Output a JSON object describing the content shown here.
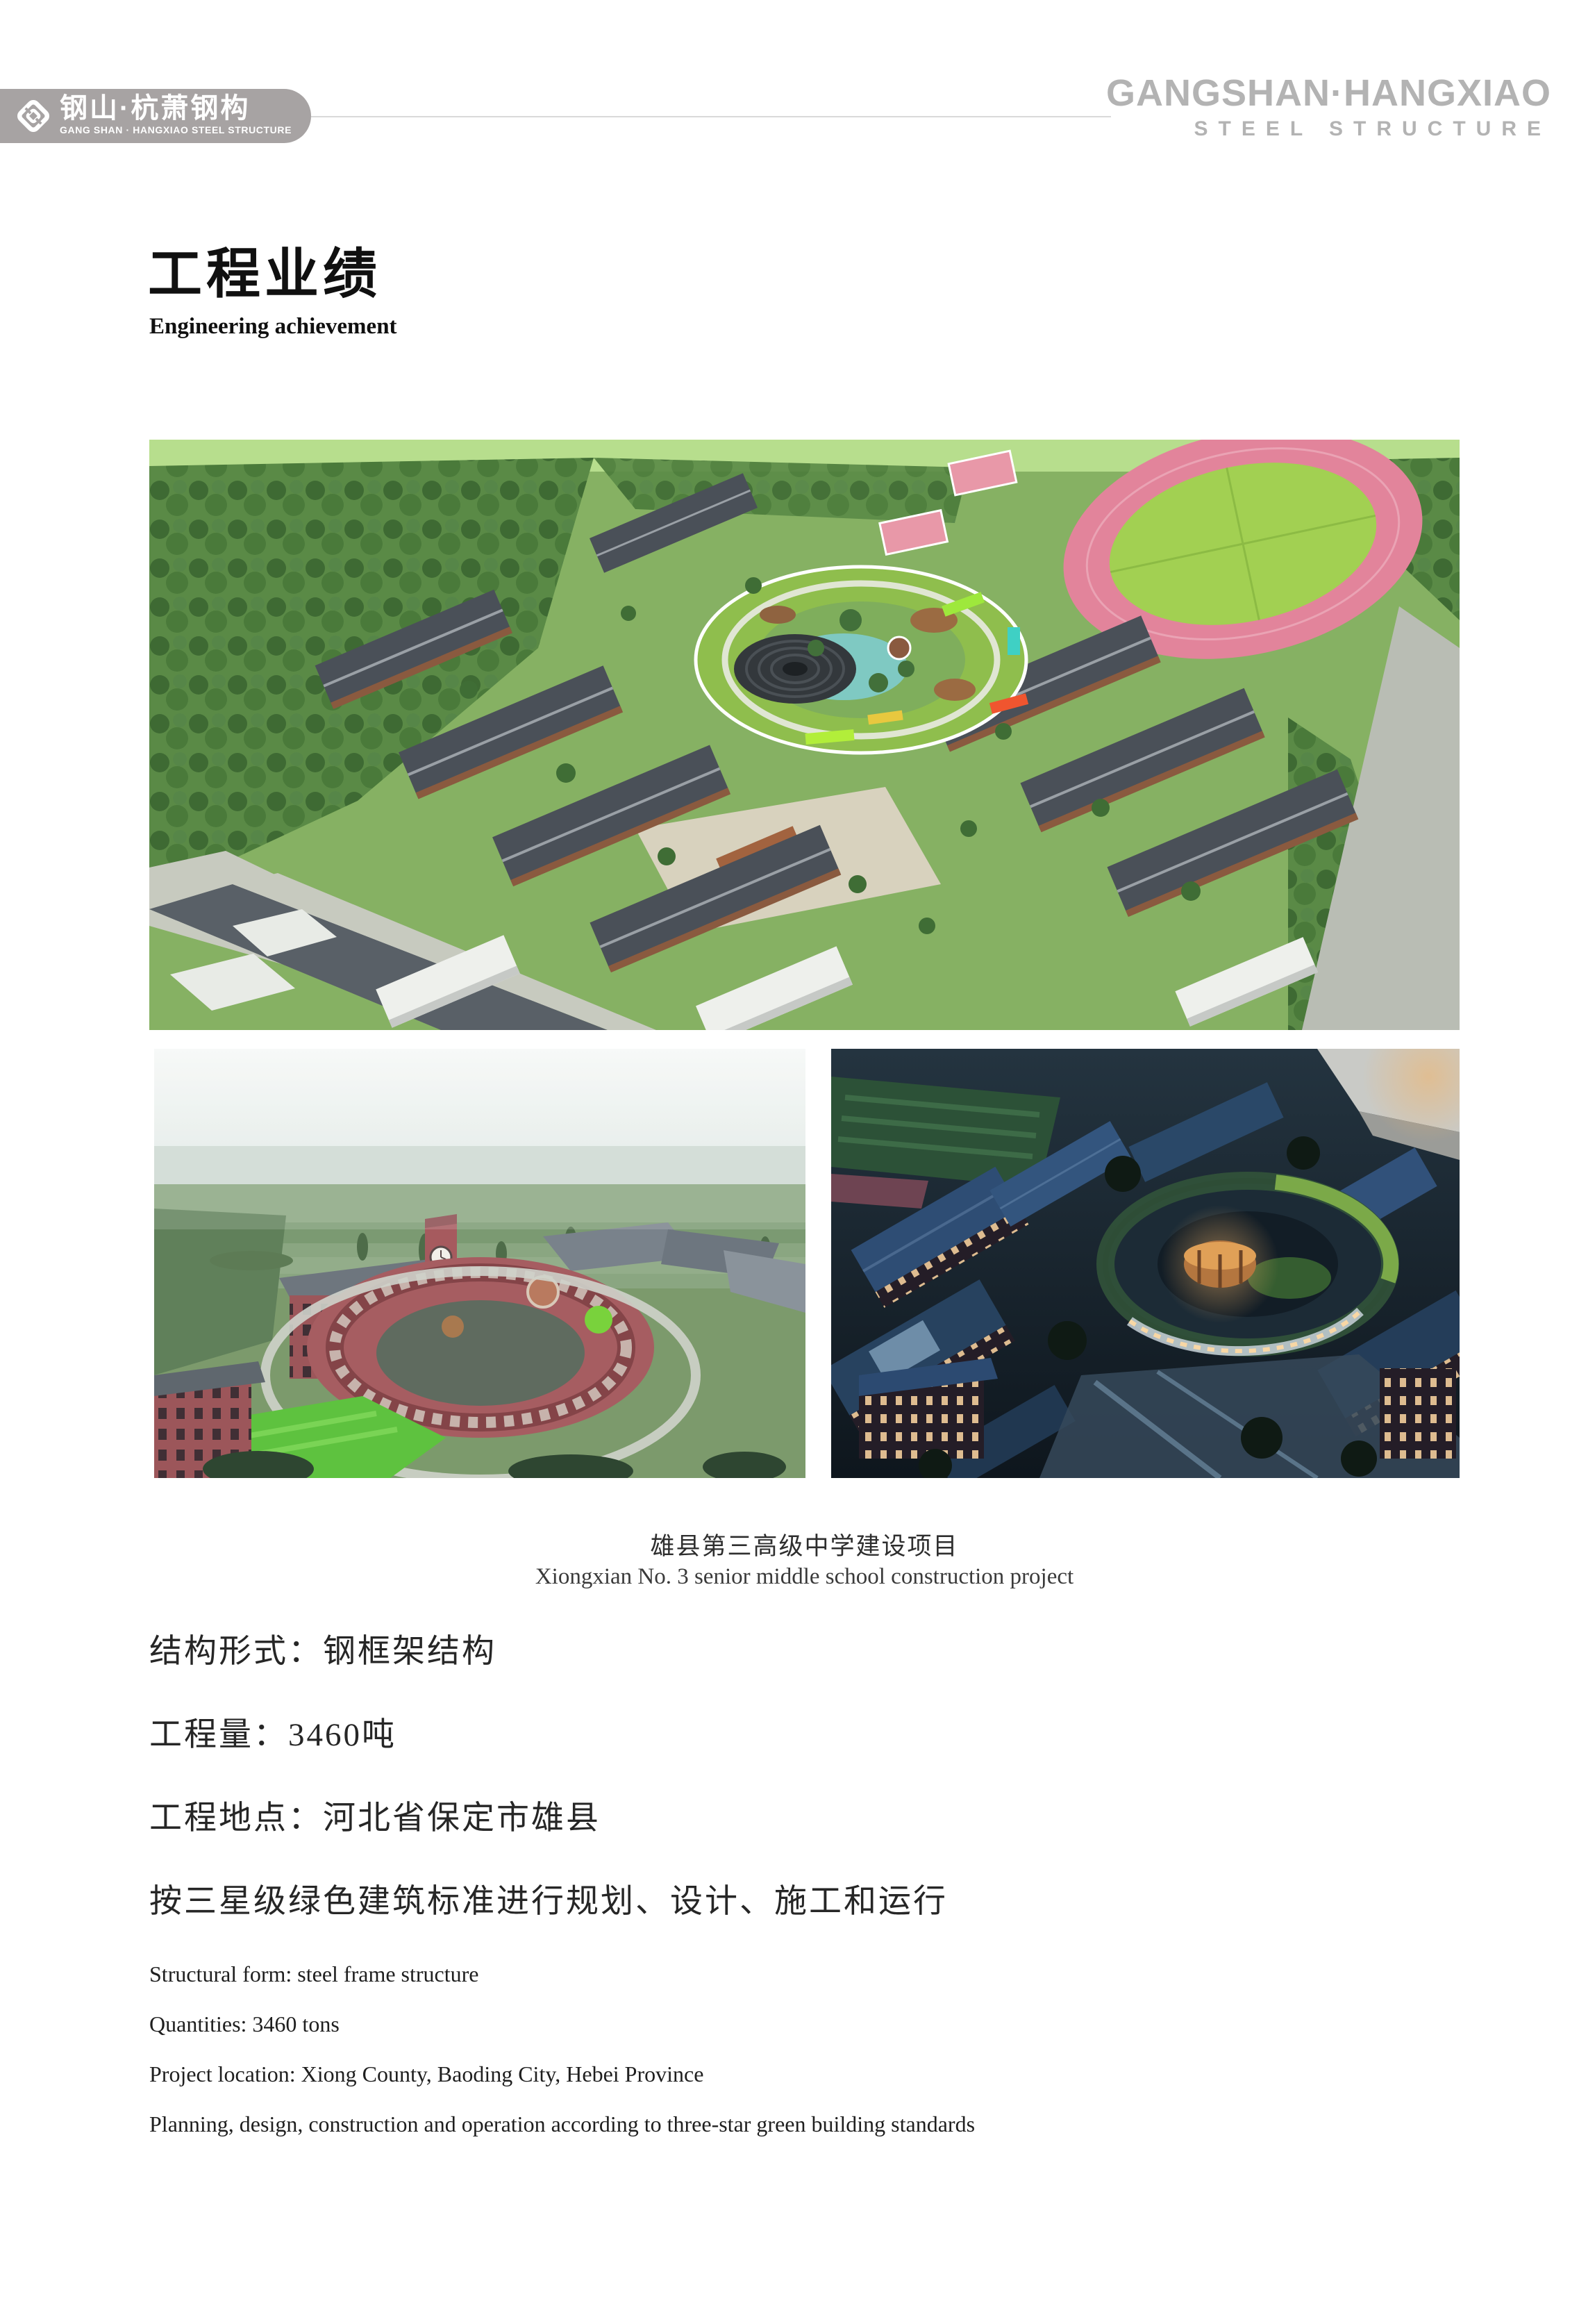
{
  "palette": {
    "banner_gray": "#a7a3a3",
    "brand_gray": "#b3b3b3",
    "rule_gray": "#d9d9d9",
    "text_black": "#101010"
  },
  "header": {
    "logo": {
      "zh": "钢山·杭萧钢构",
      "en": "GANG SHAN · HANGXIAO STEEL STRUCTURE"
    },
    "brand": {
      "line1": "GANGSHAN·HANGXIAO",
      "line2": "STEEL STRUCTURE"
    }
  },
  "title": {
    "zh": "工程业绩",
    "en": "Engineering achievement"
  },
  "caption": {
    "zh": "雄县第三高级中学建设项目",
    "en": "Xiongxian No. 3 senior middle school construction project"
  },
  "details_zh": [
    "结构形式：钢框架结构",
    "工程量：3460吨",
    "工程地点：河北省保定市雄县",
    "按三星级绿色建筑标准进行规划、设计、施工和运行"
  ],
  "details_en": [
    "Structural form: steel frame structure",
    "Quantities: 3460 tons",
    "Project location: Xiong County, Baoding City, Hebei Province",
    "Planning, design, construction and operation according to three-star green building standards"
  ]
}
